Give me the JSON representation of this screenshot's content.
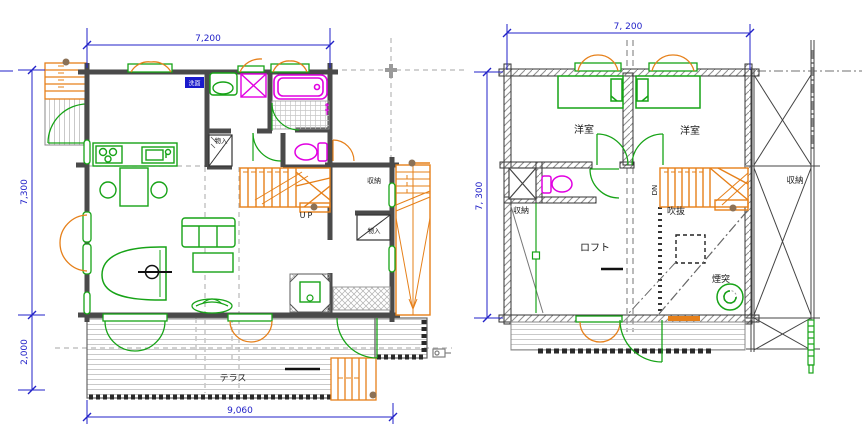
{
  "title": "log-house-floor-plans",
  "colors": {
    "wall": "#4a4a4a",
    "fixture_green": "#17a317",
    "stair_orange": "#e6801a",
    "sanitary_magenta": "#e100e1",
    "dimension_blue": "#2222c8",
    "projection_gray": "#b8b8b8"
  },
  "floor1": {
    "dimensions": {
      "top": "7,200",
      "left_upper": "7,300",
      "left_lower": "2,000",
      "bottom": "9,060"
    },
    "labels": {
      "up": "UP",
      "terrace": "テラス",
      "closet_hall": "物入",
      "storage": "収納",
      "closet_wing": "物入",
      "washroom_badge": "洗面"
    }
  },
  "floor2": {
    "dimensions": {
      "top": "7, 200",
      "left": "7, 300"
    },
    "labels": {
      "bedroom_left": "洋室",
      "bedroom_right": "洋室",
      "storage_left": "収納",
      "storage_right": "収納",
      "down": "DN",
      "void": "吹抜",
      "loft": "ロフト",
      "chimney": "煙突"
    }
  }
}
